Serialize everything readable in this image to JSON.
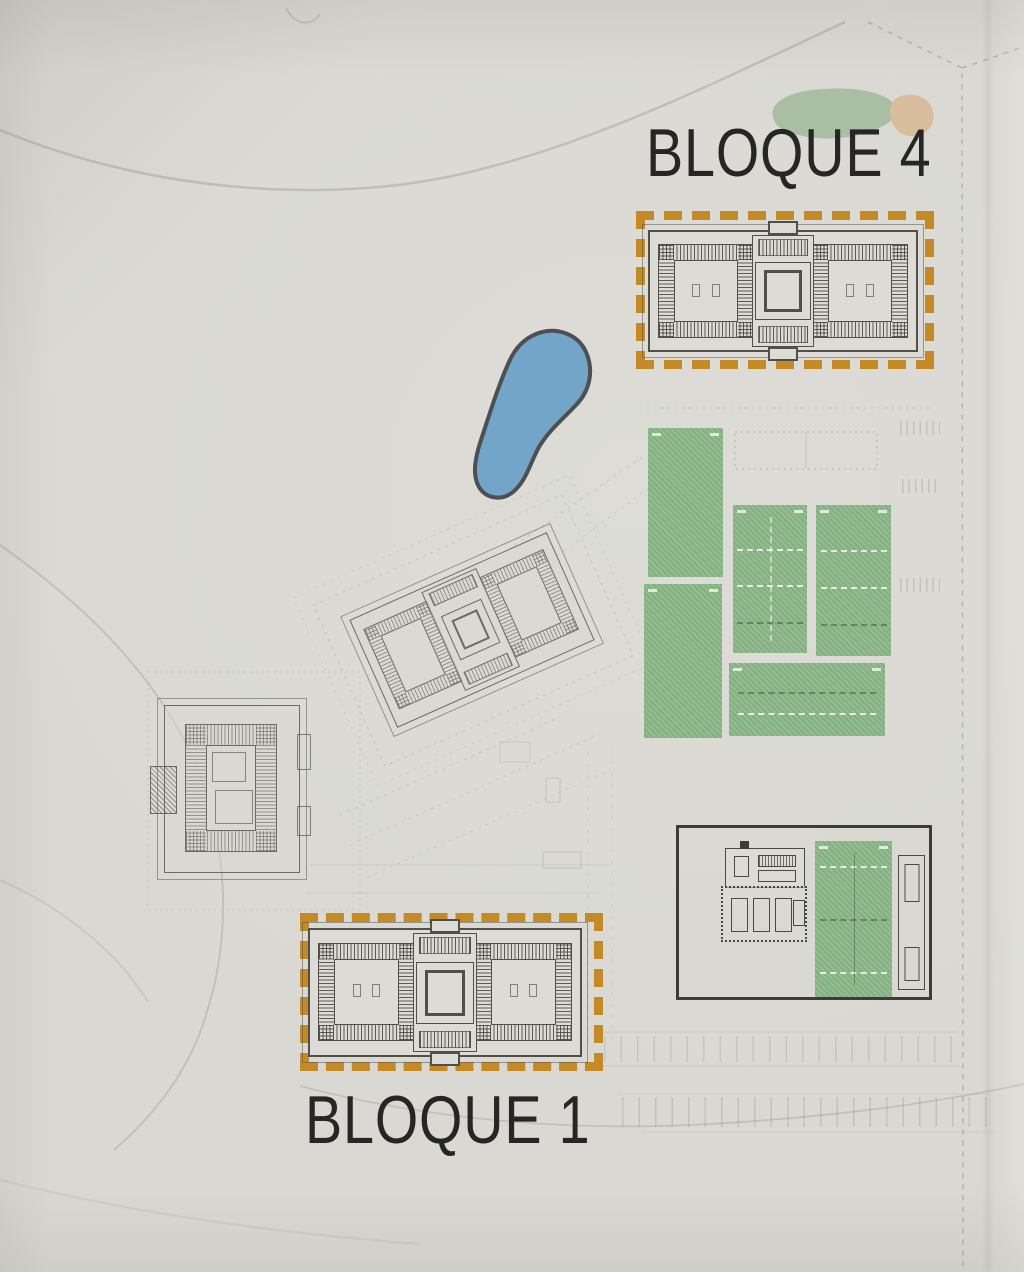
{
  "labels": {
    "bloque4": "BLOQUE 4",
    "bloque1": "BLOQUE 1"
  },
  "palette": {
    "paper": "#d9d8d2",
    "ink": "#262624",
    "plan_line": "#504f4a",
    "pencil_line": "#8b8a81",
    "terrace_orange": "#c3861d",
    "court_green": "#8cb88a",
    "pool_blue": "#73a5c8",
    "pool_outline": "#4d4f52",
    "landscape_green": "#a9bea2",
    "landscape_tan": "#d8bd9c"
  }
}
